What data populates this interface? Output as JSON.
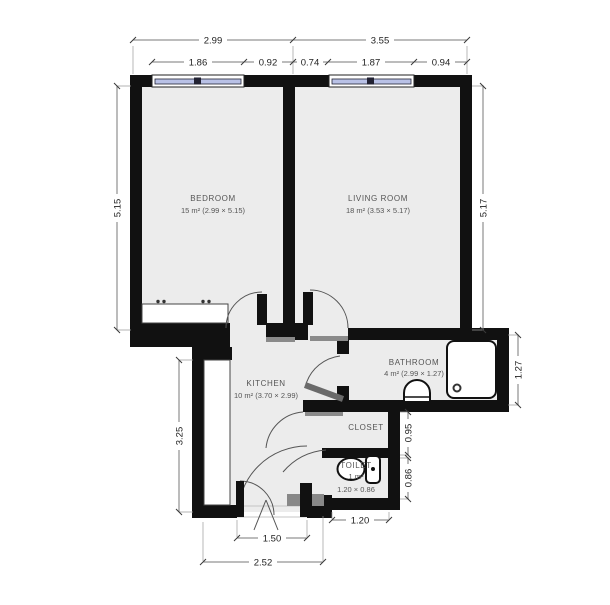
{
  "plan": {
    "type": "apartment-floor-plan",
    "units": "m"
  },
  "rooms": {
    "bedroom": {
      "name": "BEDROOM",
      "area": "15 m² (2.99 × 5.15)"
    },
    "living_room": {
      "name": "LIVING ROOM",
      "area": "18 m² (3.53 × 5.17)"
    },
    "kitchen": {
      "name": "KITCHEN",
      "area": "10 m² (3.70 × 2.99)"
    },
    "bathroom": {
      "name": "BATHROOM",
      "area": "4 m² (2.99 × 1.27)"
    },
    "closet": {
      "name": "CLOSET"
    },
    "toilet": {
      "name": "TOILET",
      "area": "1 m²",
      "size": "1.20 × 0.86"
    }
  },
  "dimensions": {
    "top_outer": [
      "2.99",
      "3.55"
    ],
    "top_inner": [
      "1.86",
      "0.92",
      "0.74",
      "1.87",
      "0.94"
    ],
    "left": [
      "5.15",
      "3.25"
    ],
    "right": [
      "5.17",
      "1.27",
      "0.95",
      "0.86"
    ],
    "bottom": [
      "1.50",
      "2.52",
      "1.20"
    ]
  },
  "fixtures": [
    "shower",
    "sink",
    "toilet",
    "wardrobe",
    "kitchen-counter"
  ],
  "colors": {
    "wall": "#111111",
    "room_fill": "#ececec",
    "window_glass": "#b9c1e6",
    "dimension_line": "#787878",
    "label_text": "#555555",
    "door_leaf_gray": "#888888"
  }
}
